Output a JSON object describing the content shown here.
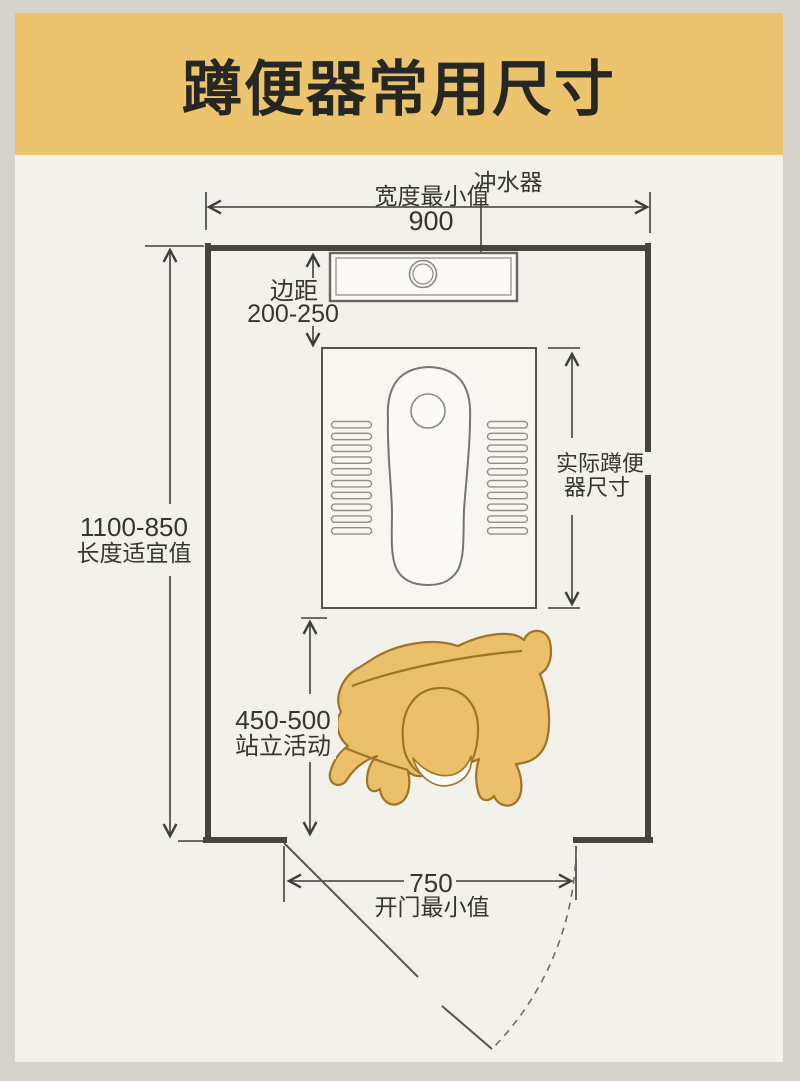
{
  "title": "蹲便器常用尺寸",
  "colors": {
    "banner": "#ecc46e",
    "card_background": "#f3f1eb",
    "frame": "#d6d3cc",
    "wall_line": "#45443e",
    "dimension_line": "#3f3e39",
    "fixture_line": "#8a8980",
    "person_fill": "#ecc06a",
    "person_outline": "#9c7526"
  },
  "diagram": {
    "flusher": {
      "label": "冲水器"
    },
    "width_dim": {
      "label": "宽度最小值",
      "value": "900"
    },
    "margin_dim": {
      "label": "边距",
      "value": "200-250"
    },
    "length_dim": {
      "value": "1100-850",
      "label": "长度适宜值"
    },
    "pan_dim": {
      "label_line1": "实际蹲便",
      "label_line2": "器尺寸"
    },
    "standing_dim": {
      "value": "450-500",
      "label": "站立活动"
    },
    "door_dim": {
      "value": "750",
      "label": "开门最小值"
    }
  }
}
